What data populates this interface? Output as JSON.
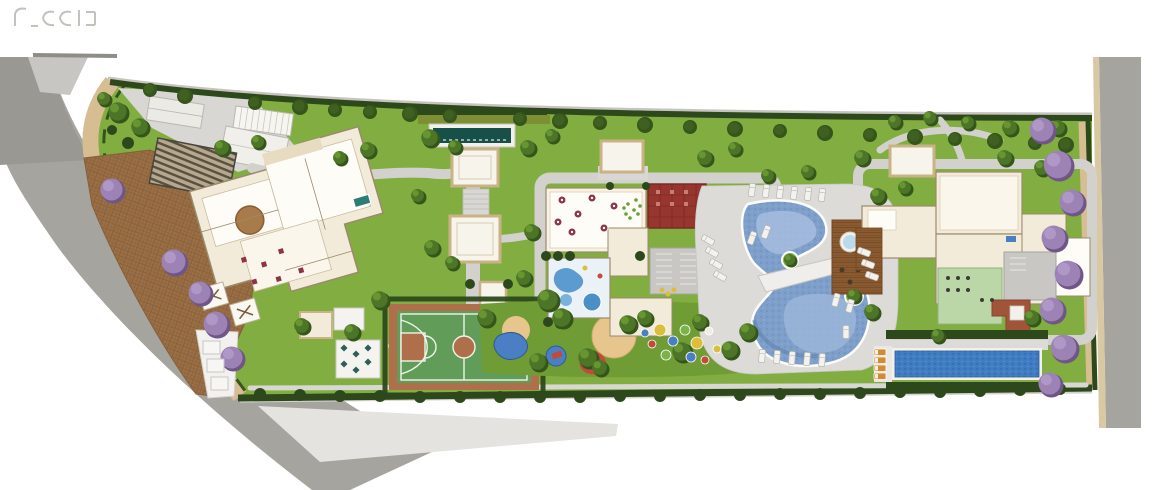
{
  "meta": {
    "type": "residential condominium masterplan / site plan rendering (top view)",
    "canvas_width": 1154,
    "canvas_height": 490
  },
  "watermark": {
    "color": "#b7b3ae"
  },
  "palette": {
    "bg": "#ffffff",
    "street": "#a6a49f",
    "street_dark": "#9a9892",
    "sidewalk": "#e4e3e0",
    "corner": "#c7c6c2",
    "curb": "#d9c9a2",
    "walk": "#d6bd92",
    "cobble": "#9a6f45",
    "cobble_line": "#875f3a",
    "lawn": "#82ae41",
    "lawn_dark": "#6f9c35",
    "hedge": "#2d491b",
    "hedge_olive": "#7d8f33",
    "path": "#d2d1cd",
    "deck": "#dcdbd7",
    "plaza": "#d8d7d4",
    "cream": "#f3ebda",
    "cream_line": "#9b8a6b",
    "room_white": "#fdfcf7",
    "trim": "#c9b285",
    "roof_red": "#97362f",
    "roof_red_line": "#7c2a26",
    "reflecting_pool": "#175049",
    "pool": "#7e9fca",
    "pool_light": "#a4bcde",
    "pool_dark": "#5c7dab",
    "pool_rim": "#fbfbf9",
    "lap_pool": "#3f7cc1",
    "court_green": "#619d58",
    "court_clay": "#b06f4b",
    "court_line": "#eef4ea",
    "wood": "#8a5a33",
    "wood_line": "#74481f",
    "sand": "#e7c68e",
    "tree": "#4d7527",
    "tree_dark": "#35551a",
    "tree_light": "#699934",
    "purple": "#9d83b5",
    "purple_dark": "#6f5687",
    "purple_light": "#b49cc9",
    "lounger": "#f3f2ee",
    "lounger_line": "#b9b7b0",
    "lounger_orange": "#d28a33",
    "rug": "#a87b4b",
    "spa": "#bcd9ea",
    "gym": "#bcd7a7",
    "table_maroon": "#8e3448",
    "play": {
      "yellow": "#dcbe3c",
      "red": "#c34a39",
      "blue": "#4b7fc3",
      "green": "#7cb14b",
      "white": "#efece4",
      "brown": "#6d4125"
    }
  },
  "areas": [
    "left-street",
    "right-street",
    "perimeter-walk",
    "cobblestone-driveway",
    "entrance-canopy",
    "gatehouse",
    "trellis",
    "reflecting-pool",
    "pergolas",
    "tower-1-amenity-floor",
    "tower-2-amenity-floor",
    "tower-3-amenity-floor",
    "event-room",
    "red-roof-room",
    "kids-splash-room",
    "gym-room",
    "sports-court",
    "playground",
    "leisure-pool",
    "pool-bridge",
    "spa-wood-deck",
    "lap-pool",
    "sun-deck",
    "dining-patio",
    "parking-bays",
    "lawn",
    "hedges",
    "purple-ipe-trees"
  ],
  "vegetation": {
    "green_trees": [
      [
        118,
        112,
        10
      ],
      [
        140,
        127,
        9
      ],
      [
        104,
        99,
        7
      ],
      [
        222,
        148,
        8
      ],
      [
        258,
        142,
        7
      ],
      [
        340,
        158,
        7
      ],
      [
        368,
        150,
        8
      ],
      [
        430,
        138,
        9
      ],
      [
        455,
        147,
        7
      ],
      [
        418,
        196,
        7
      ],
      [
        432,
        248,
        8
      ],
      [
        452,
        263,
        7
      ],
      [
        528,
        148,
        8
      ],
      [
        552,
        136,
        7
      ],
      [
        532,
        232,
        8
      ],
      [
        524,
        278,
        8
      ],
      [
        705,
        158,
        8
      ],
      [
        735,
        149,
        7
      ],
      [
        768,
        176,
        7
      ],
      [
        808,
        172,
        7
      ],
      [
        862,
        158,
        8
      ],
      [
        878,
        196,
        8
      ],
      [
        905,
        188,
        7
      ],
      [
        968,
        123,
        7
      ],
      [
        1010,
        128,
        8
      ],
      [
        1058,
        128,
        8
      ],
      [
        1005,
        158,
        8
      ],
      [
        1042,
        168,
        8
      ],
      [
        302,
        326,
        8
      ],
      [
        352,
        332,
        8
      ],
      [
        380,
        300,
        9
      ],
      [
        486,
        318,
        9
      ],
      [
        548,
        300,
        11
      ],
      [
        562,
        318,
        10
      ],
      [
        538,
        362,
        9
      ],
      [
        588,
        358,
        10
      ],
      [
        600,
        368,
        8
      ],
      [
        628,
        324,
        9
      ],
      [
        645,
        318,
        8
      ],
      [
        682,
        352,
        10
      ],
      [
        700,
        322,
        8
      ],
      [
        730,
        350,
        9
      ],
      [
        748,
        332,
        9
      ],
      [
        790,
        260,
        6
      ],
      [
        854,
        296,
        7
      ],
      [
        872,
        312,
        8
      ],
      [
        938,
        336,
        7
      ],
      [
        1032,
        318,
        8
      ],
      [
        930,
        118,
        7
      ],
      [
        895,
        122,
        7
      ]
    ],
    "top_row_trees": [
      [
        150,
        90,
        7
      ],
      [
        185,
        96,
        8
      ],
      [
        255,
        103,
        7
      ],
      [
        300,
        107,
        8
      ],
      [
        335,
        110,
        7
      ],
      [
        370,
        112,
        7
      ],
      [
        410,
        114,
        8
      ],
      [
        450,
        116,
        7
      ],
      [
        520,
        119,
        7
      ],
      [
        560,
        121,
        8
      ],
      [
        600,
        123,
        7
      ],
      [
        645,
        125,
        8
      ],
      [
        690,
        127,
        7
      ],
      [
        735,
        129,
        8
      ],
      [
        780,
        131,
        7
      ],
      [
        825,
        133,
        8
      ],
      [
        870,
        135,
        7
      ],
      [
        915,
        137,
        8
      ],
      [
        955,
        139,
        7
      ],
      [
        995,
        141,
        8
      ],
      [
        1035,
        143,
        7
      ],
      [
        1066,
        145,
        8
      ]
    ],
    "shrubs": [
      [
        260,
        394,
        6
      ],
      [
        300,
        395,
        6
      ],
      [
        340,
        396,
        6
      ],
      [
        380,
        396,
        6
      ],
      [
        420,
        397,
        6
      ],
      [
        460,
        397,
        6
      ],
      [
        500,
        397,
        6
      ],
      [
        540,
        397,
        6
      ],
      [
        580,
        397,
        6
      ],
      [
        620,
        396,
        6
      ],
      [
        660,
        396,
        6
      ],
      [
        700,
        395,
        6
      ],
      [
        740,
        395,
        6
      ],
      [
        780,
        394,
        6
      ],
      [
        820,
        394,
        6
      ],
      [
        860,
        393,
        6
      ],
      [
        900,
        392,
        6
      ],
      [
        940,
        392,
        6
      ],
      [
        980,
        391,
        6
      ],
      [
        1020,
        390,
        6
      ],
      [
        1060,
        389,
        6
      ],
      [
        546,
        256,
        5
      ],
      [
        558,
        256,
        5
      ],
      [
        570,
        256,
        5
      ],
      [
        640,
        256,
        5
      ],
      [
        610,
        186,
        4
      ],
      [
        646,
        186,
        4
      ],
      [
        548,
        322,
        5
      ],
      [
        560,
        324,
        5
      ],
      [
        470,
        284,
        5
      ],
      [
        508,
        284,
        5
      ],
      [
        128,
        143,
        6
      ],
      [
        112,
        130,
        5
      ]
    ],
    "purple_trees": [
      [
        112,
        190,
        12
      ],
      [
        174,
        262,
        13
      ],
      [
        200,
        293,
        12
      ],
      [
        216,
        324,
        13
      ],
      [
        232,
        358,
        12
      ],
      [
        1042,
        130,
        13
      ],
      [
        1058,
        165,
        15
      ],
      [
        1072,
        202,
        13
      ],
      [
        1054,
        238,
        13
      ],
      [
        1068,
        274,
        14
      ],
      [
        1052,
        310,
        13
      ],
      [
        1064,
        348,
        14
      ],
      [
        1050,
        384,
        12
      ]
    ]
  },
  "furniture": {
    "white_loungers": [
      [
        752,
        190,
        8
      ],
      [
        766,
        191,
        8
      ],
      [
        780,
        192,
        8
      ],
      [
        794,
        193,
        8
      ],
      [
        808,
        194,
        8
      ],
      [
        822,
        195,
        8
      ],
      [
        708,
        240,
        -60
      ],
      [
        712,
        252,
        -60
      ],
      [
        716,
        264,
        -60
      ],
      [
        720,
        276,
        -60
      ],
      [
        762,
        356,
        5
      ],
      [
        777,
        357,
        5
      ],
      [
        792,
        358,
        5
      ],
      [
        807,
        359,
        5
      ],
      [
        822,
        360,
        5
      ],
      [
        864,
        252,
        -70
      ],
      [
        868,
        264,
        -70
      ],
      [
        872,
        276,
        -70
      ],
      [
        752,
        238,
        20
      ],
      [
        766,
        232,
        20
      ],
      [
        836,
        300,
        15
      ],
      [
        850,
        306,
        15
      ],
      [
        846,
        332,
        0
      ]
    ],
    "orange_loungers": [
      [
        880,
        352
      ],
      [
        880,
        360
      ],
      [
        880,
        368
      ],
      [
        880,
        376
      ]
    ],
    "party_tables": [
      [
        562,
        200
      ],
      [
        578,
        214
      ],
      [
        592,
        198
      ],
      [
        604,
        228
      ],
      [
        572,
        232
      ],
      [
        614,
        206
      ],
      [
        558,
        222
      ]
    ],
    "party_minidots": [
      [
        628,
        204
      ],
      [
        634,
        210
      ],
      [
        626,
        214
      ],
      [
        636,
        200
      ],
      [
        630,
        218
      ],
      [
        638,
        214
      ],
      [
        624,
        208
      ],
      [
        640,
        206
      ]
    ],
    "patio_tables": [
      [
        344,
        348
      ],
      [
        356,
        354
      ],
      [
        368,
        348
      ],
      [
        344,
        364
      ],
      [
        356,
        370
      ],
      [
        368,
        362
      ]
    ],
    "play_dots": [
      [
        660,
        330,
        6,
        "yellow"
      ],
      [
        673,
        341,
        5,
        "blue"
      ],
      [
        685,
        330,
        5,
        "green"
      ],
      [
        697,
        343,
        6,
        "yellow"
      ],
      [
        709,
        331,
        4,
        "white"
      ],
      [
        666,
        355,
        5,
        "green"
      ],
      [
        691,
        357,
        5,
        "blue"
      ],
      [
        705,
        360,
        4,
        "red"
      ],
      [
        652,
        344,
        4,
        "red"
      ],
      [
        717,
        349,
        4,
        "yellow"
      ],
      [
        645,
        333,
        4,
        "blue"
      ]
    ],
    "parking_bays": [
      [
        203,
        341
      ],
      [
        207,
        359
      ],
      [
        211,
        377
      ]
    ],
    "gym_dots": [
      [
        948,
        278
      ],
      [
        958,
        278
      ],
      [
        968,
        278
      ],
      [
        948,
        290
      ],
      [
        958,
        290
      ],
      [
        968,
        290
      ],
      [
        982,
        300
      ],
      [
        992,
        300
      ]
    ]
  }
}
